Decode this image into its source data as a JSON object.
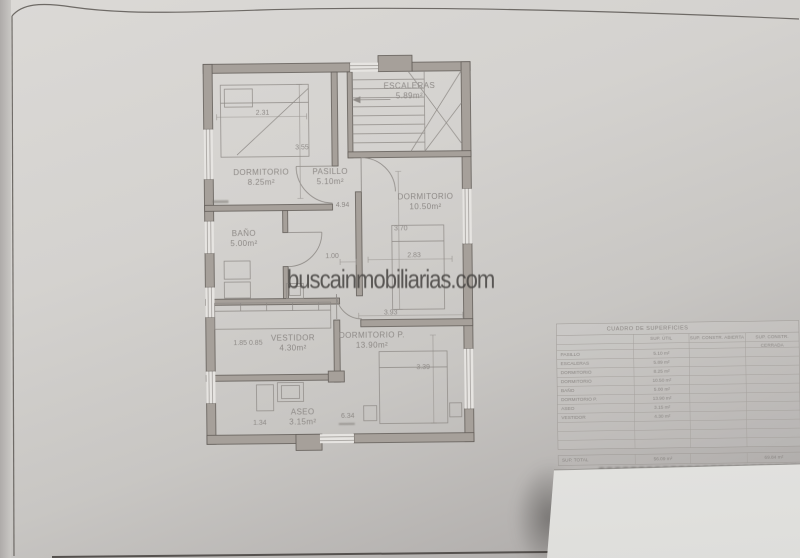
{
  "watermark": "buscainmobiliarias.com",
  "plan": {
    "rooms": {
      "dormitorio1": {
        "name": "DORMITORIO",
        "area": "8.25m²"
      },
      "pasillo": {
        "name": "PASILLO",
        "area": "5.10m²"
      },
      "escaleras": {
        "name": "ESCALERAS",
        "area": "5.89m²"
      },
      "dormitorio2": {
        "name": "DORMITORIO",
        "area": "10.50m²"
      },
      "bano": {
        "name": "BAÑO",
        "area": "5.00m²"
      },
      "vestidor": {
        "name": "VESTIDOR",
        "area": "4.30m²"
      },
      "dormitorioP": {
        "name": "DORMITORIO P.",
        "area": "13.90m²"
      },
      "aseo": {
        "name": "ASEO",
        "area": "3.15m²"
      }
    },
    "dims": {
      "d231": "2.31",
      "d355": "3.55",
      "d494": "4.94",
      "d100": "1.00",
      "d370": "3.70",
      "d283": "2.83",
      "d393": "3.93",
      "d185": "1.85 0.85",
      "d339": "3.39",
      "d634": "6.34",
      "d134": "1.34"
    }
  },
  "table": {
    "title": "CUADRO DE SUPERFICIES",
    "col_util": "SUP. ÚTIL",
    "col_abierta": "SUP. CONSTR. ABIERTA",
    "col_cerrada": "SUP. CONSTR. CERRADA",
    "rows": [
      {
        "name": "PASILLO",
        "util": "5.10 m²"
      },
      {
        "name": "ESCALERAS",
        "util": "5.89 m²"
      },
      {
        "name": "DORMITORIO",
        "util": "8.25 m²"
      },
      {
        "name": "DORMITORIO",
        "util": "10.50 m²"
      },
      {
        "name": "BAÑO",
        "util": "5.00 m²"
      },
      {
        "name": "DORMITORIO P.",
        "util": "13.90 m²"
      },
      {
        "name": "ASEO",
        "util": "3.15 m²"
      },
      {
        "name": "VESTIDOR",
        "util": "4.30 m²"
      }
    ],
    "total_label": "SUP. TOTAL",
    "total_util": "56.09 m²",
    "total_cerrada": "69.84 m²"
  }
}
